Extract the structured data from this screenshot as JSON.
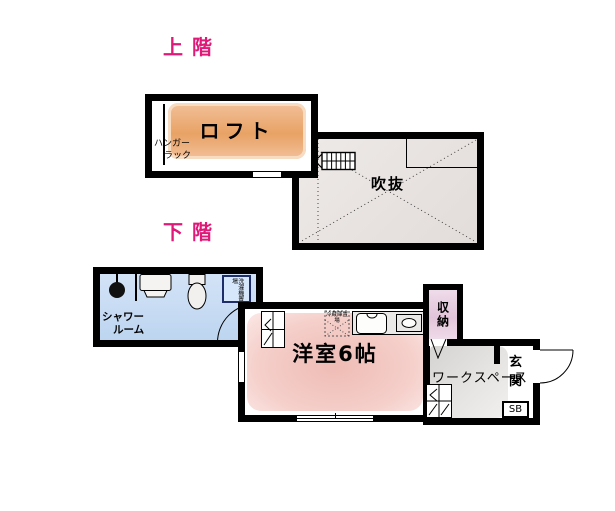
{
  "colors": {
    "label_pink": "#e01878",
    "wall": "#000000",
    "loft1": "#f2c099",
    "loft2": "#e8a265",
    "void1": "#eeeae8",
    "void2": "#e2dcda",
    "shower1": "#d3e3f7",
    "shower2": "#bdd5f0",
    "room1": "#efbcb5",
    "room2": "#f5cfca",
    "closet1": "#efdcea",
    "closet2": "#e2c4d9",
    "gray1": "#d5d3d1",
    "gray2": "#f1f0ef",
    "washer_border": "#1c2d69",
    "washer_fill": "#d7e7fb"
  },
  "labels": {
    "upper_floor": "上階",
    "lower_floor": "下階"
  },
  "rooms": {
    "loft": {
      "name": "ロフト",
      "hanger_rack": [
        "ハンガー",
        "ラック"
      ]
    },
    "void": {
      "name": "吹抜"
    },
    "shower": {
      "name_lines": [
        "シャワー",
        "ルーム"
      ],
      "washer_label": "洗濯機置場"
    },
    "main": {
      "name": "洋室6帖",
      "fridge_label": "冷蔵庫置場"
    },
    "closet": {
      "name": "収納"
    },
    "workspace": {
      "name": "ワークスペース"
    },
    "entrance": {
      "name": "玄関",
      "shoe_box": "SB"
    }
  }
}
